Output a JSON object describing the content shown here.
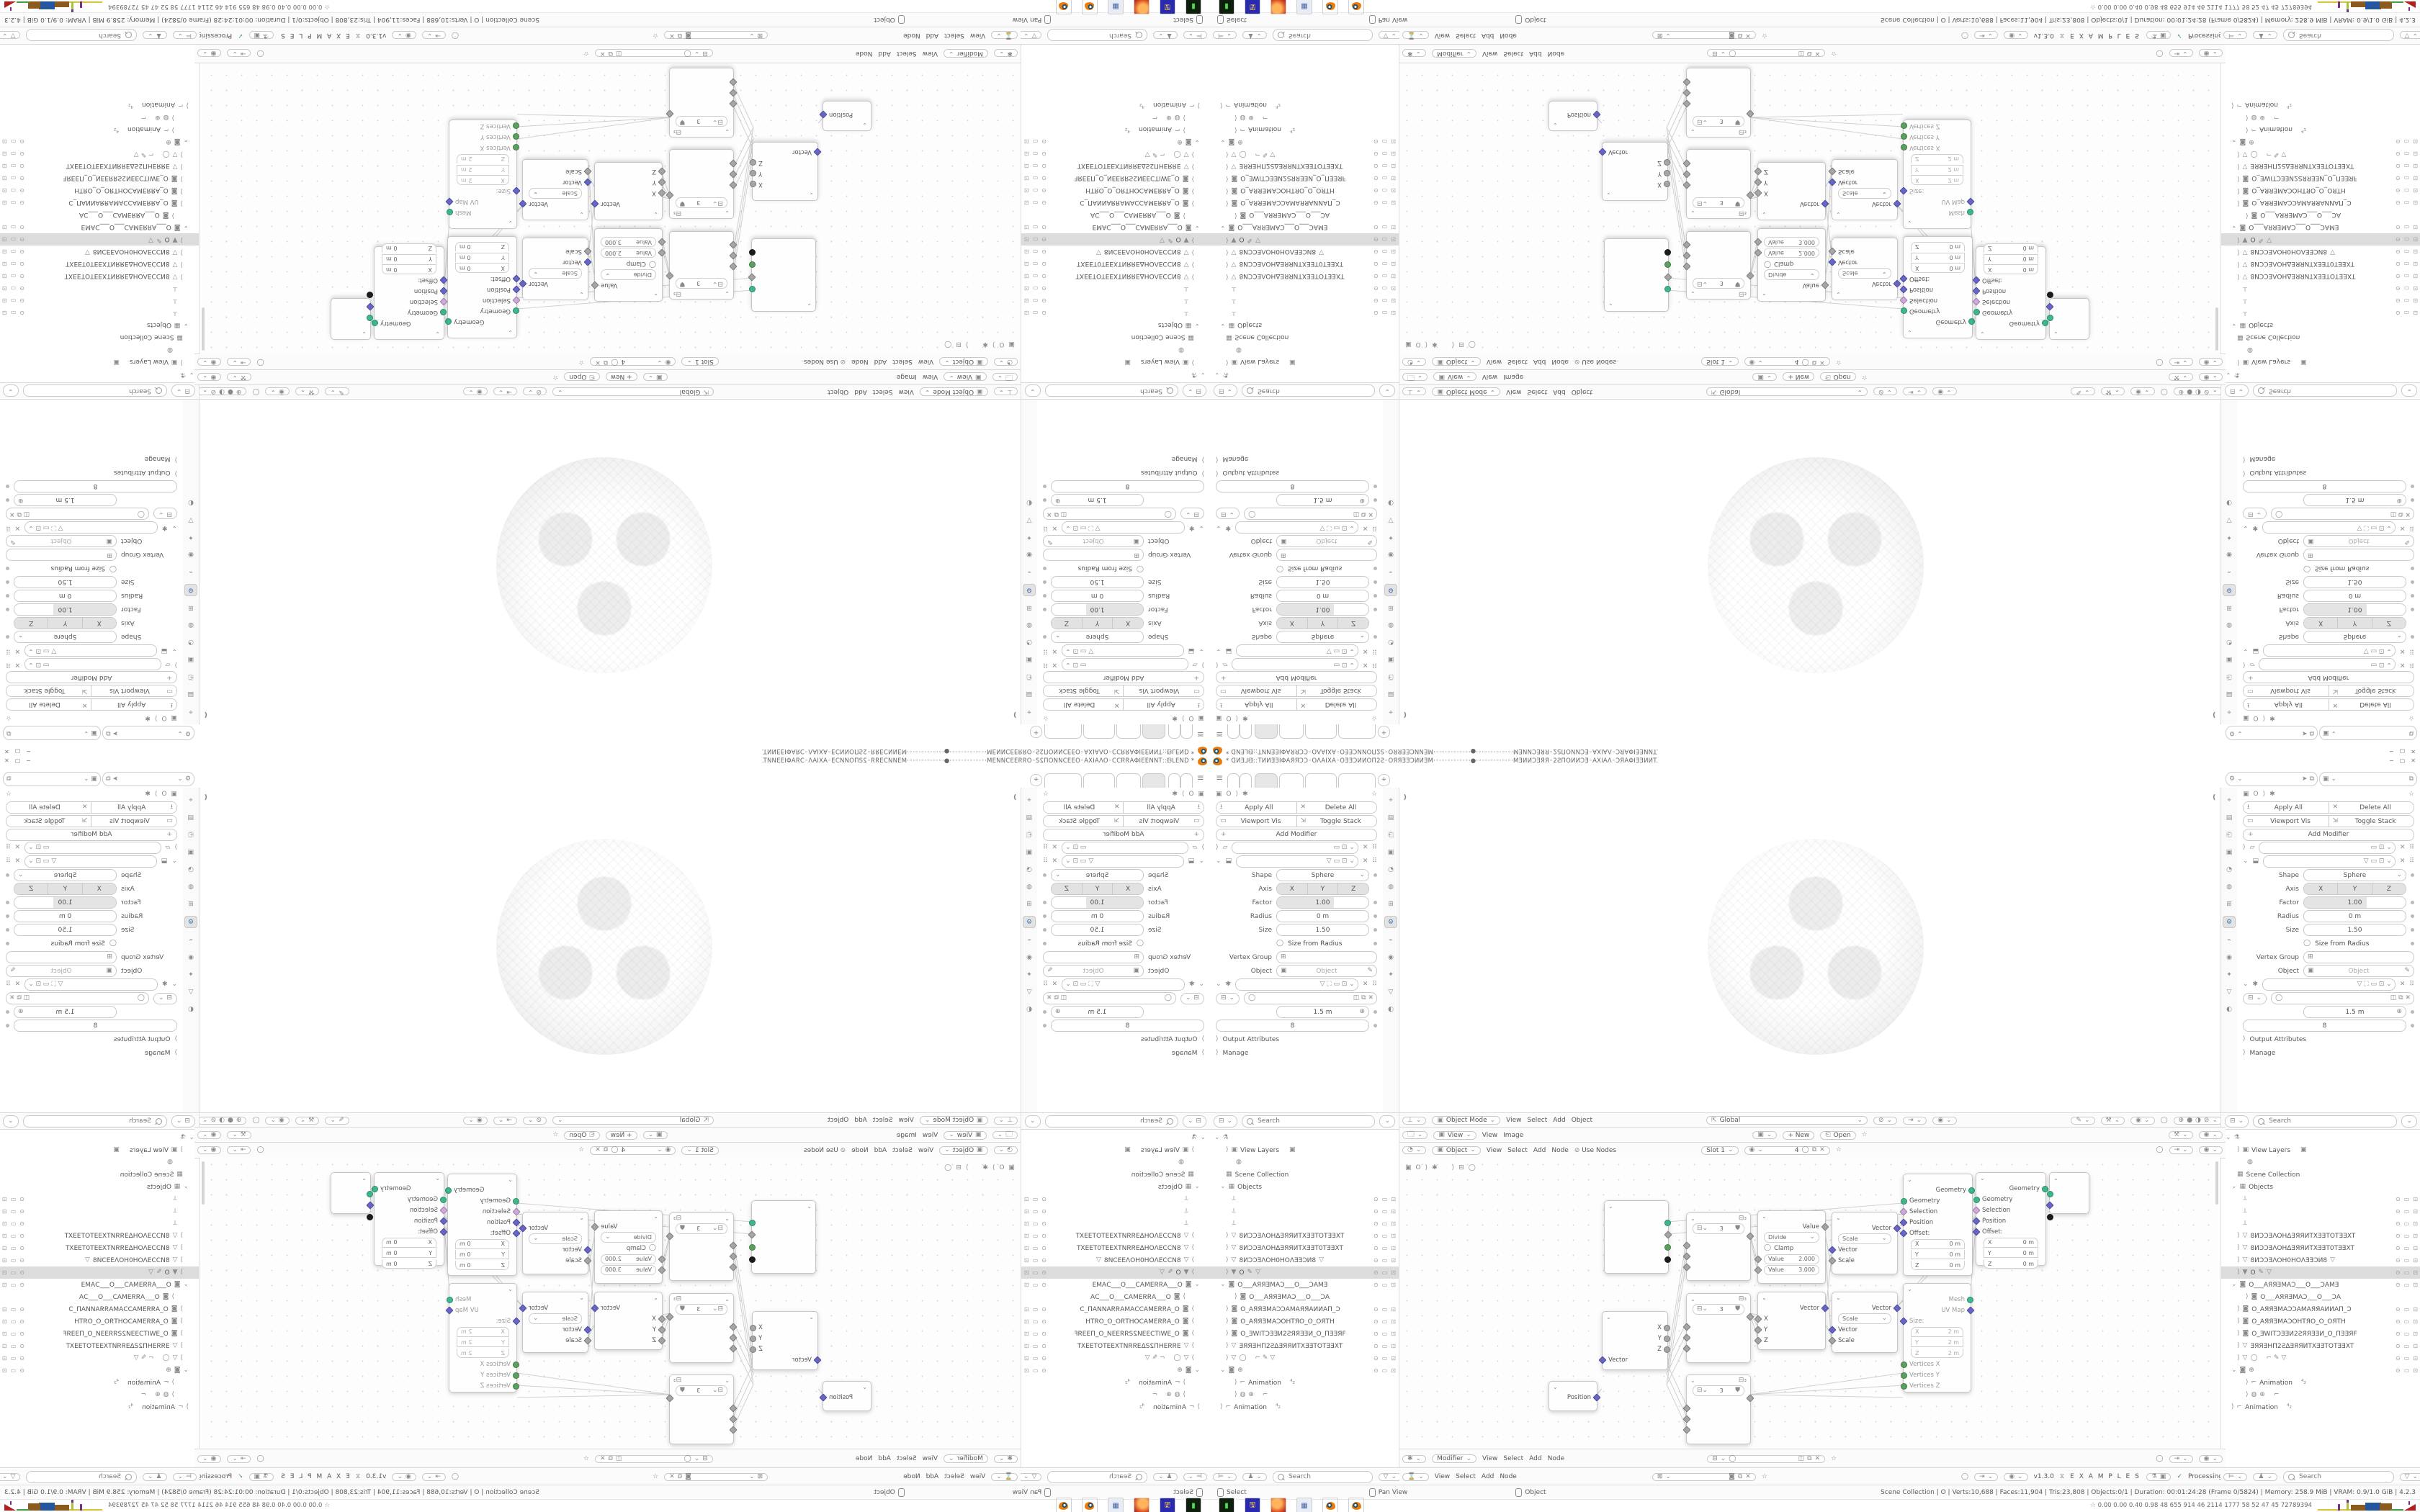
{
  "window": {
    "title": "* ᗡИƎ⅃ᙠ::TИИƎƎIΦAЯЯƆƆ◦OΛAIXA◦OƎƎƆИИOΠ2Ƨ◦OЯЯƎƎƆИИƎM·◦·◦·◦·◦·◦·◦·●·◦·◦·◦·◦·◦·◦·MƎИИƆƎЯЯ◦2ƧΠOИИƆƎ◦AXIAΛ◦ƆЯAΦIƎƎИИT.",
    "minimize": "−",
    "restore": "▢",
    "close": "✕"
  },
  "topbar": {
    "hamburger": "≡",
    "add_tab": "+"
  },
  "properties": {
    "apply_all": "Apply All",
    "delete_all": "Delete All",
    "viewport_vis": "Viewport Vis",
    "toggle_stack": "Toggle Stack",
    "add_modifier": "Add Modifier",
    "shape_label": "Shape",
    "shape_value": "Sphere",
    "axis_label": "Axis",
    "axis_x": "X",
    "axis_y": "Y",
    "axis_z": "Z",
    "factor_label": "Factor",
    "factor_value": "1.00",
    "radius_label": "Radius",
    "radius_value": "0 m",
    "size_label": "Size",
    "size_value": "1.50",
    "size_from_radius": "Size from Radius",
    "vertex_group_label": "Vertex Group",
    "object_label": "Object",
    "object_placeholder": "Object",
    "node_size_value": "1.5 m",
    "node_count_value": "8",
    "output_attributes": "Output Attributes",
    "manage": "Manage"
  },
  "viewport": {
    "mode": "Object Mode",
    "m_view": "View",
    "m_select": "Select",
    "m_add": "Add",
    "m_object": "Object",
    "orientation": "Global"
  },
  "image_ed": {
    "view": "View",
    "m_view": "View",
    "m_image": "Image",
    "new": "+ New",
    "open": "Open"
  },
  "shader_ed": {
    "type": "Object",
    "m_view": "View",
    "m_select": "Select",
    "m_add": "Add",
    "m_node": "Node",
    "use_nodes": "Use Nodes",
    "slot": "Slot 1",
    "count": "4"
  },
  "geonode": {
    "mode": "Modifier",
    "m_view": "View",
    "m_select": "Select",
    "m_add": "Add",
    "m_node": "Node"
  },
  "addon": {
    "m_view": "View",
    "m_select": "Select",
    "m_add": "Add",
    "m_node": "Node",
    "version": "v1.3.0",
    "examples": "E X A M P L E S",
    "processing": "Processing"
  },
  "status": {
    "select": "Select",
    "pan": "Pan View",
    "object": "Object",
    "info": "Scene Collection | O | Verts:10,688 | Faces:11,904 | Tris:23,808 | Objects:0/1 | Duration: 00:01:24:28 (Frame 0/5824) | Memory: 258.9 MiB | VRAM: 0.9/1.0 GiB | 4.2.3"
  },
  "taskbar": {
    "monitor": "0.00 0.00 0.40 0.98   48   655   914   46   2114 1777   58   52   47   45   72789394"
  },
  "outliner": {
    "search": "Search",
    "rows": [
      {
        "label": ""
      },
      {
        "label": "View Layers"
      },
      {
        "label": ""
      },
      {
        "label": "Scene Collection"
      },
      {
        "label": "Objects"
      },
      {
        "label": ""
      },
      {
        "label": ""
      },
      {
        "label": ""
      },
      {
        "label": "8ИƆƆƎΛOHΔƎЯЯИTXƎƎTOTƎƎXT"
      },
      {
        "label": "8ИƆƆƎΛOHΔƎЯЯИTXƎƎT0TƎƎXT"
      },
      {
        "label": "8ИƆƆƎΛOH0HOΛƎƎƆИ8"
      },
      {
        "label": "O"
      },
      {
        "label": "O___AЯЯƎMAƆ___O___ƆAMƎ"
      },
      {
        "label": "O___AЯЯƎMAƆ___O___ƆA"
      },
      {
        "label": "O_AЯЯƎMAƆƆAMAЯЯAИИAΠ_Ɔ"
      },
      {
        "label": "O_AЯЯƎMAƆOHTЯO_O_OЯTH"
      },
      {
        "label": "O_ƎWITƆƎƎИ2ƧЯЯƎƎИ_O_ΠƎƎЯF"
      },
      {
        "label": "ƎЯЯƎHΠ2ƧΔƎЯЯИTXƎƎTOTƎƎXT"
      },
      {
        "label": ""
      },
      {
        "label": ""
      },
      {
        "label": "Animation"
      },
      {
        "label": ""
      },
      {
        "label": "Animation"
      }
    ]
  },
  "nodes": {
    "position_out": "Position",
    "sep": {
      "vector": "Vector",
      "x": "X",
      "y": "Y",
      "z": "Z"
    },
    "shield_val": "3",
    "math": {
      "out": "Value",
      "op": "Divide",
      "clamp": "Clamp",
      "val_label": "Value",
      "v1": "2.000",
      "v2": "3.000"
    },
    "comb": {
      "out": "Vector",
      "x": "X",
      "y": "Y",
      "z": "Z"
    },
    "scale": {
      "out": "Vector",
      "op": "Scale",
      "vector": "Vector",
      "scale": "Scale"
    },
    "setpos": {
      "out": "Geometry",
      "geometry": "Geometry",
      "selection": "Selection",
      "position": "Position",
      "offset": "Offset:",
      "x": "X",
      "y": "Y",
      "z": "Z",
      "zero": "0 m"
    },
    "cube": {
      "mesh": "Mesh",
      "uv": "UV Map",
      "size": "Size:",
      "x": "X",
      "y": "Y",
      "z": "Z",
      "two": "2 m",
      "vx": "Vertices X",
      "vy": "Vertices Y",
      "vz": "Vertices Z"
    }
  },
  "colors": {
    "accent": "#4772b3",
    "blender_orange": "#e87d0d",
    "socket_geometry": "#3db88a",
    "socket_vector": "#6766c8",
    "socket_bool": "#cfa8de",
    "socket_int": "#5aa05e"
  }
}
